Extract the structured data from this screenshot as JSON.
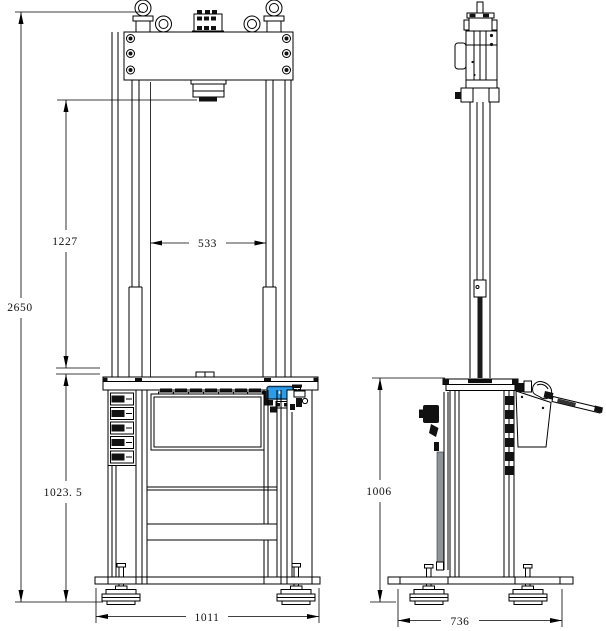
{
  "drawing": {
    "kind": "two-view dimensioned engineering drawing of a column press / test machine",
    "views": {
      "front": "front-view",
      "side": "side-view"
    },
    "colors": {
      "line": "#000000",
      "accent_blue": "#2d9de9",
      "gray_panel": "#8f9498",
      "dark_fill": "#111111",
      "background": "#ffffff"
    }
  },
  "dimensions": {
    "overall_height": {
      "value": "2650"
    },
    "daylight_height": {
      "value": "1227"
    },
    "column_clearance": {
      "value": "533"
    },
    "table_height": {
      "value": "1023. 5"
    },
    "base_width": {
      "value": "1011"
    },
    "stand_height": {
      "value": "1006"
    },
    "base_depth": {
      "value": "736"
    }
  }
}
